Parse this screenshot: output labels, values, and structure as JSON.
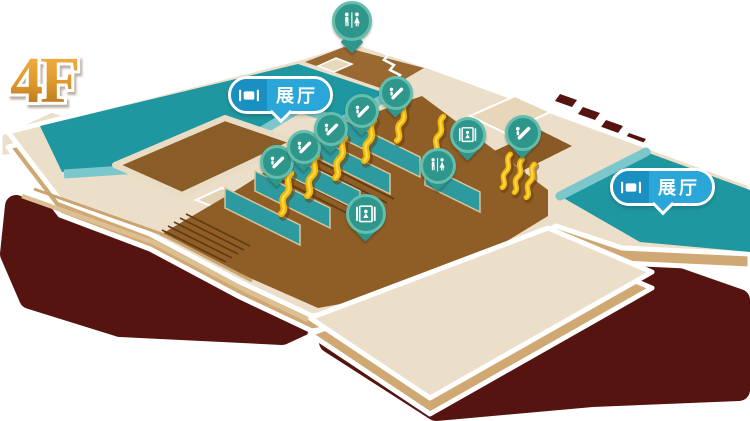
{
  "floor": {
    "label": "4F"
  },
  "badges": {
    "left": {
      "label": "展厅"
    },
    "right": {
      "label": "展厅"
    }
  },
  "map": {
    "markers": [
      {
        "type": "restroom",
        "x": 352,
        "y": 21,
        "size": 40,
        "tail": "long"
      },
      {
        "type": "escalator",
        "x": 277,
        "y": 162,
        "size": 34
      },
      {
        "type": "escalator",
        "x": 304,
        "y": 147,
        "size": 34
      },
      {
        "type": "escalator",
        "x": 331,
        "y": 129,
        "size": 34
      },
      {
        "type": "escalator",
        "x": 362,
        "y": 111,
        "size": 34
      },
      {
        "type": "escalator",
        "x": 396,
        "y": 93,
        "size": 34
      },
      {
        "type": "escalator",
        "x": 523,
        "y": 133,
        "size": 36
      },
      {
        "type": "elevator",
        "x": 468,
        "y": 135,
        "size": 36
      },
      {
        "type": "elevator",
        "x": 366,
        "y": 214,
        "size": 40
      },
      {
        "type": "restroom",
        "x": 438,
        "y": 166,
        "size": 36
      }
    ]
  },
  "colors": {
    "shadow_maroon": "#551410",
    "floor_cream": "#ecdfca",
    "floor_side_tan": "#cfa873",
    "concourse_brown": "#8f5e27",
    "hall_teal": "#1e97a0",
    "wall_teal_light": "#7cc7cb",
    "partition_teal": "#2d9aa0",
    "escalator_yellow": "#f2b705",
    "marker_fill": "#2f968c",
    "marker_ring": "#63bead",
    "badge_blue": "#2aa7d8",
    "badge_icon_blue": "#1a90c2",
    "label_gold": "#d28a20",
    "outline_white": "#ffffff"
  }
}
